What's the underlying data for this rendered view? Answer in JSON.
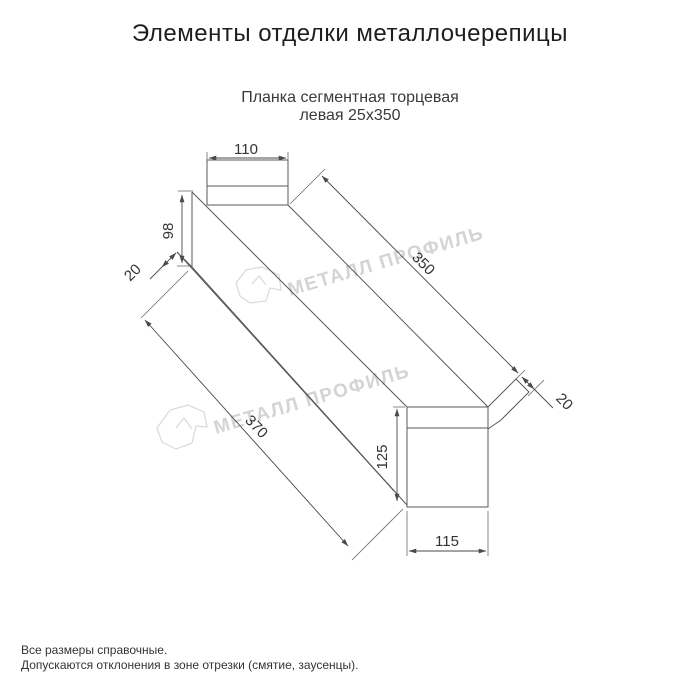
{
  "page": {
    "title": "Элементы отделки металлочерепицы"
  },
  "drawing": {
    "subtitle_line1": "Планка сегментная торцевая",
    "subtitle_line2": "левая 25х350",
    "dimensions": {
      "top_width": "110",
      "near_height": "98",
      "near_fold": "20",
      "length_top": "350",
      "far_fold": "20",
      "length_bottom": "370",
      "far_height": "125",
      "far_width": "115"
    },
    "watermark_text": "МЕТАЛЛ ПРОФИЛЬ",
    "colors": {
      "object_line": "#585858",
      "dimension_line": "#4a4a4a",
      "dimension_text": "#333333",
      "watermark": "#d4d4d4"
    }
  },
  "footer": {
    "line1": "Все размеры справочные.",
    "line2": "Допускаются отклонения в зоне отрезки (смятие, заусенцы)."
  }
}
